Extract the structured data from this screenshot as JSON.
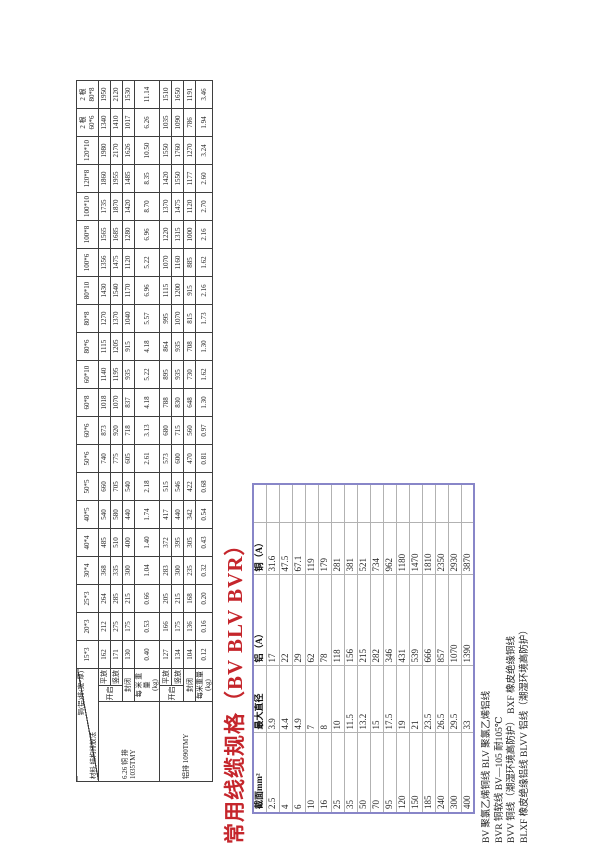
{
  "title": "常用线缆规格（BV BLV BVR）",
  "colors": {
    "title_red": "#c5262c",
    "cable_border_purple": "#8886c8"
  },
  "busbar_table": {
    "corner_top": "铜(铝)排(宽*厚)",
    "corner_bottom": "材料  结构排放法",
    "columns": [
      "15*3",
      "20*3",
      "25*3",
      "30*4",
      "40*4",
      "40*5",
      "50*5",
      "50*6",
      "60*6",
      "60*8",
      "60*10",
      "80*6",
      "80*8",
      "80*10",
      "100*6",
      "100*8",
      "100*10",
      "120*8",
      "120*10",
      "2 根\n60*6",
      "2 根\n80*8"
    ],
    "groups": [
      {
        "material": "6.26 铜 排\n1035TMY",
        "open_label": "开启",
        "rows": [
          {
            "label": "平放",
            "values": [
              "162",
              "212",
              "264",
              "368",
              "485",
              "540",
              "660",
              "740",
              "873",
              "1018",
              "1140",
              "1115",
              "1270",
              "1430",
              "1356",
              "1565",
              "1735",
              "1860",
              "1980",
              "1340",
              "1950"
            ]
          },
          {
            "label": "竖放",
            "values": [
              "171",
              "275",
              "285",
              "335",
              "510",
              "580",
              "705",
              "775",
              "920",
              "1070",
              "1195",
              "1205",
              "1370",
              "1540",
              "1475",
              "1685",
              "1870",
              "1955",
              "2170",
              "1410",
              "2120"
            ]
          },
          {
            "label": "封闭",
            "values": [
              "130",
              "175",
              "215",
              "300",
              "400",
              "440",
              "540",
              "605",
              "718",
              "837",
              "935",
              "915",
              "1040",
              "1170",
              "1120",
              "1280",
              "1420",
              "1485",
              "1626",
              "1017",
              "1530"
            ]
          },
          {
            "label": "每 米 重 量\n(kg)",
            "values": [
              "0.40",
              "0.53",
              "0.66",
              "1.04",
              "1.40",
              "1.74",
              "2.18",
              "2.61",
              "3.13",
              "4.18",
              "5.22",
              "4.18",
              "5.57",
              "6.96",
              "5.22",
              "6.96",
              "8.70",
              "8.35",
              "10.50",
              "6.26",
              "11.14"
            ]
          }
        ]
      },
      {
        "material": "铝排 1090TMY",
        "open_label": "开启",
        "rows": [
          {
            "label": "平放",
            "values": [
              "127",
              "166",
              "205",
              "283",
              "372",
              "417",
              "515",
              "573",
              "680",
              "788",
              "895",
              "864",
              "995",
              "1115",
              "1070",
              "1220",
              "1370",
              "1420",
              "1550",
              "1035",
              "1510"
            ]
          },
          {
            "label": "竖放",
            "values": [
              "134",
              "175",
              "215",
              "300",
              "395",
              "440",
              "546",
              "600",
              "715",
              "830",
              "935",
              "935",
              "1070",
              "1200",
              "1160",
              "1315",
              "1475",
              "1550",
              "1760",
              "1090",
              "1650"
            ]
          },
          {
            "label": "封闭",
            "values": [
              "104",
              "136",
              "168",
              "235",
              "305",
              "342",
              "422",
              "470",
              "560",
              "648",
              "730",
              "708",
              "815",
              "915",
              "885",
              "1000",
              "1120",
              "1177",
              "1270",
              "786",
              "1191"
            ]
          },
          {
            "label": "每米重量(kg)",
            "values": [
              "0.12",
              "0.16",
              "0.20",
              "0.32",
              "0.43",
              "0.54",
              "0.68",
              "0.81",
              "0.97",
              "1.30",
              "1.62",
              "1.30",
              "1.73",
              "2.16",
              "1.62",
              "2.16",
              "2.70",
              "2.60",
              "3.24",
              "1.94",
              "3.46"
            ]
          }
        ]
      }
    ]
  },
  "cable_table": {
    "headers": [
      "截面mm²",
      "最大直径",
      "铝（A）",
      "铜（A）",
      ""
    ],
    "rows": [
      [
        "2.5",
        "3.9",
        "17",
        "31.6",
        ""
      ],
      [
        "4",
        "4.4",
        "22",
        "47.5",
        ""
      ],
      [
        "6",
        "4.9",
        "29",
        "67.1",
        ""
      ],
      [
        "10",
        "7",
        "62",
        "119",
        ""
      ],
      [
        "16",
        "8",
        "78",
        "179",
        ""
      ],
      [
        "25",
        "10",
        "118",
        "281",
        ""
      ],
      [
        "35",
        "11.5",
        "156",
        "381",
        ""
      ],
      [
        "50",
        "13.2",
        "215",
        "521",
        ""
      ],
      [
        "70",
        "15",
        "282",
        "734",
        ""
      ],
      [
        "95",
        "17.5",
        "346",
        "962",
        ""
      ],
      [
        "120",
        "19",
        "431",
        "1180",
        ""
      ],
      [
        "150",
        "21",
        "539",
        "1470",
        ""
      ],
      [
        "185",
        "23.5",
        "666",
        "1810",
        ""
      ],
      [
        "240",
        "26.5",
        "857",
        "2350",
        ""
      ],
      [
        "300",
        "29.5",
        "1070",
        "2930",
        ""
      ],
      [
        "400",
        "33",
        "1390",
        "3870",
        ""
      ]
    ]
  },
  "notes": [
    "BV 聚氯乙烯铜线  BLV 聚氯乙烯铝线",
    "BVR 铜软线  BV—105 耐105℃",
    "BVV 铜线（潮湿环境高防护） BXF 橡皮绝缘铜线",
    "BLXF 橡皮绝缘铝线  BLVV 铝线（潮湿环境高防护）"
  ]
}
